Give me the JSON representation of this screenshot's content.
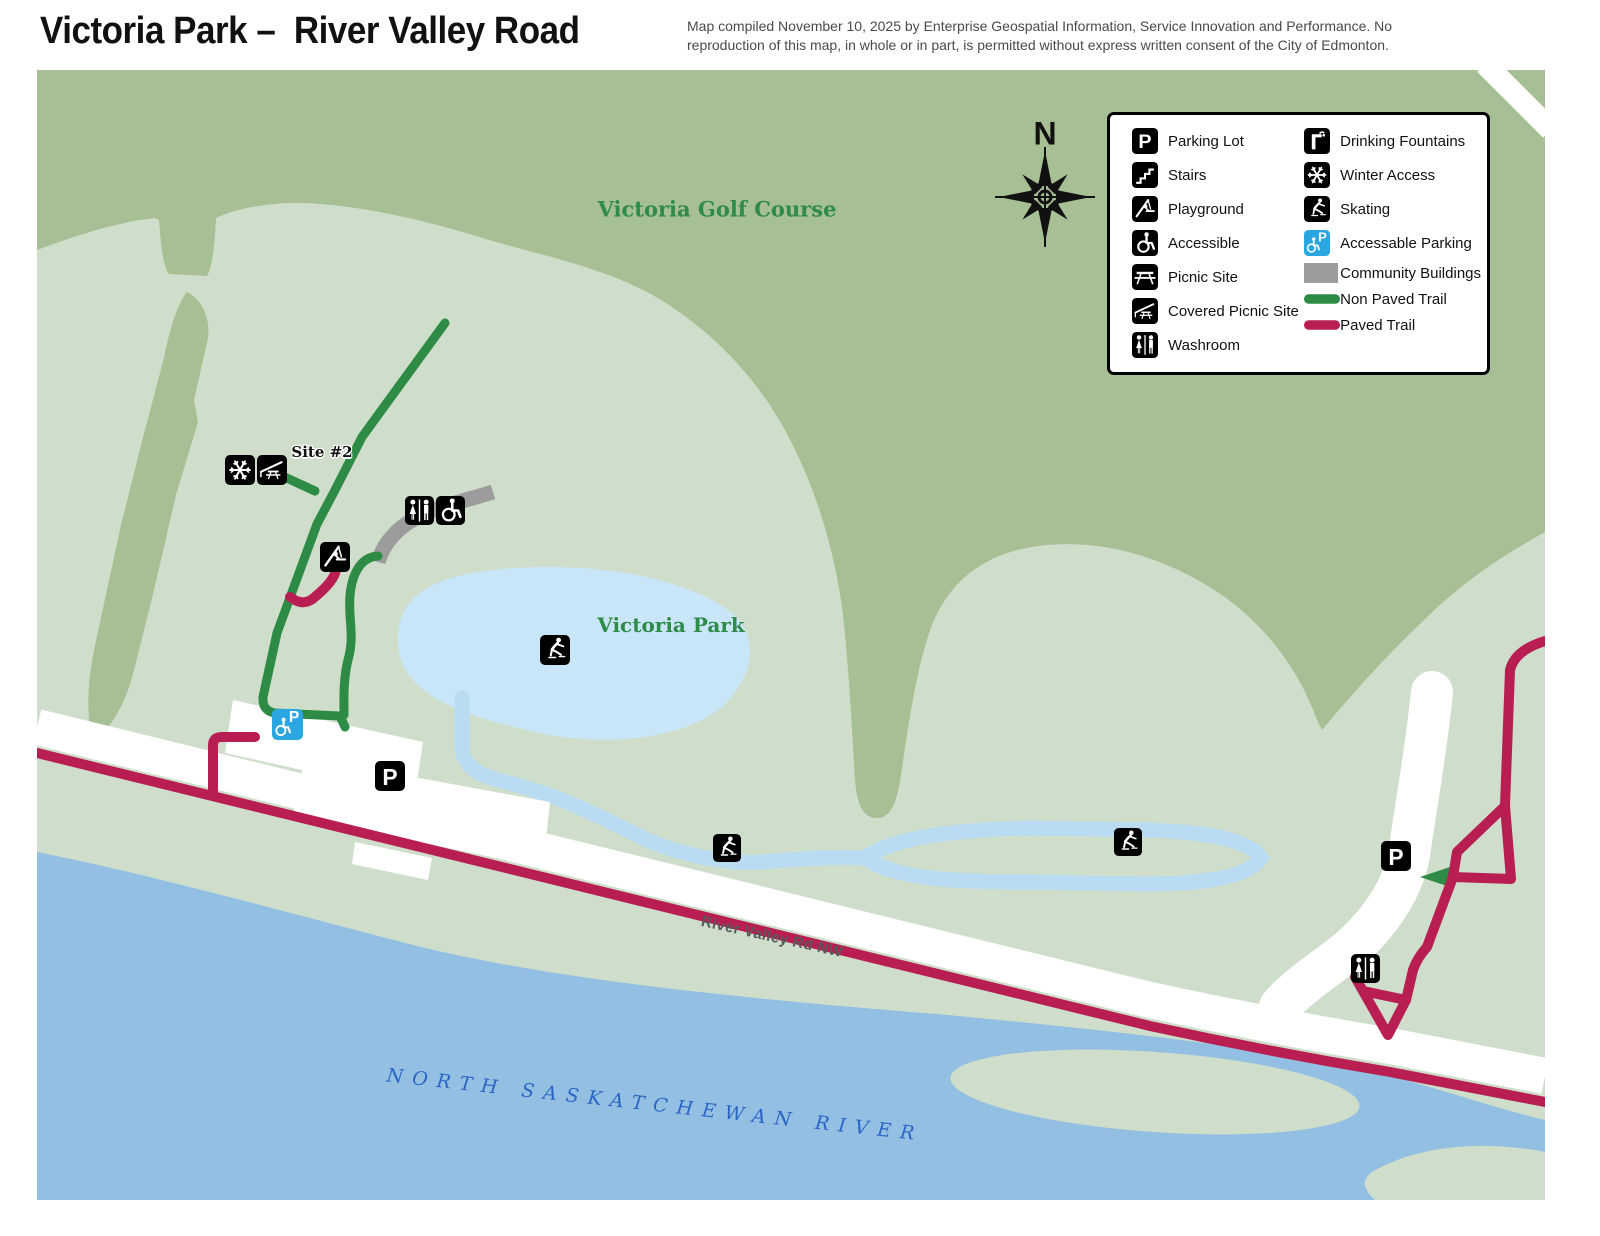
{
  "header": {
    "title": "Victoria Park –  River Valley Road",
    "disclaimer_line1": "Map compiled November 10, 2025 by Enterprise Geospatial Information, Service Innovation and Performance. No",
    "disclaimer_line2": "reproduction of this map, in whole or in part, is permitted without express written consent of the City of Edmonton."
  },
  "legend": {
    "left": [
      {
        "icon": "parking",
        "label": "Parking Lot"
      },
      {
        "icon": "stairs",
        "label": "Stairs"
      },
      {
        "icon": "playground",
        "label": "Playground"
      },
      {
        "icon": "accessible",
        "label": "Accessible"
      },
      {
        "icon": "picnic",
        "label": "Picnic Site"
      },
      {
        "icon": "covered-picnic",
        "label": "Covered Picnic Site"
      },
      {
        "icon": "washroom",
        "label": "Washroom"
      }
    ],
    "right": [
      {
        "icon": "fountain",
        "label": "Drinking Fountains"
      },
      {
        "icon": "winter",
        "label": "Winter Access"
      },
      {
        "icon": "skating",
        "label": "Skating"
      },
      {
        "icon": "accessible-parking",
        "label": "Accessable Parking"
      },
      {
        "icon": "community",
        "label": "Community Buildings"
      },
      {
        "icon": "line-green",
        "label": "Non Paved Trail"
      },
      {
        "icon": "line-crimson",
        "label": "Paved Trail"
      }
    ]
  },
  "map": {
    "compass_n": "N",
    "labels": {
      "golf_course": "Victoria Golf Course",
      "park": "Victoria Park",
      "site": "Site #2",
      "road": "River Valley Rd NW",
      "river": "NORTH SASKATCHEWAN RIVER"
    },
    "markers": [
      {
        "type": "winter",
        "x": 203,
        "y": 400,
        "s": 30
      },
      {
        "type": "covered-picnic",
        "x": 235,
        "y": 400,
        "s": 30
      },
      {
        "type": "washroom",
        "x": 382,
        "y": 440,
        "s": 29
      },
      {
        "type": "accessible",
        "x": 413,
        "y": 440,
        "s": 29
      },
      {
        "type": "playground",
        "x": 298,
        "y": 487,
        "s": 30
      },
      {
        "type": "skating",
        "x": 518,
        "y": 580,
        "s": 30
      },
      {
        "type": "skating",
        "x": 690,
        "y": 778,
        "s": 28
      },
      {
        "type": "skating",
        "x": 1091,
        "y": 772,
        "s": 28
      },
      {
        "type": "accessible-parking",
        "x": 250,
        "y": 654,
        "s": 31
      },
      {
        "type": "parking",
        "x": 353,
        "y": 706,
        "s": 30
      },
      {
        "type": "parking",
        "x": 1359,
        "y": 786,
        "s": 30
      },
      {
        "type": "washroom",
        "x": 1328,
        "y": 898,
        "s": 29
      }
    ]
  },
  "colors": {
    "dark_green": "#a7bf94",
    "pale_green": "#cfdecb",
    "pond": "#c9e6f8",
    "ice": "#badcf2",
    "river": "#93bfe3",
    "trail_green": "#2e8b45",
    "trail_crimson": "#b81e52",
    "gray_building": "#9c9c9c",
    "ap_blue": "#2aa7e0",
    "label_green": "#2e8b4a",
    "river_label": "#2b66c4",
    "road_label": "#58585a"
  }
}
